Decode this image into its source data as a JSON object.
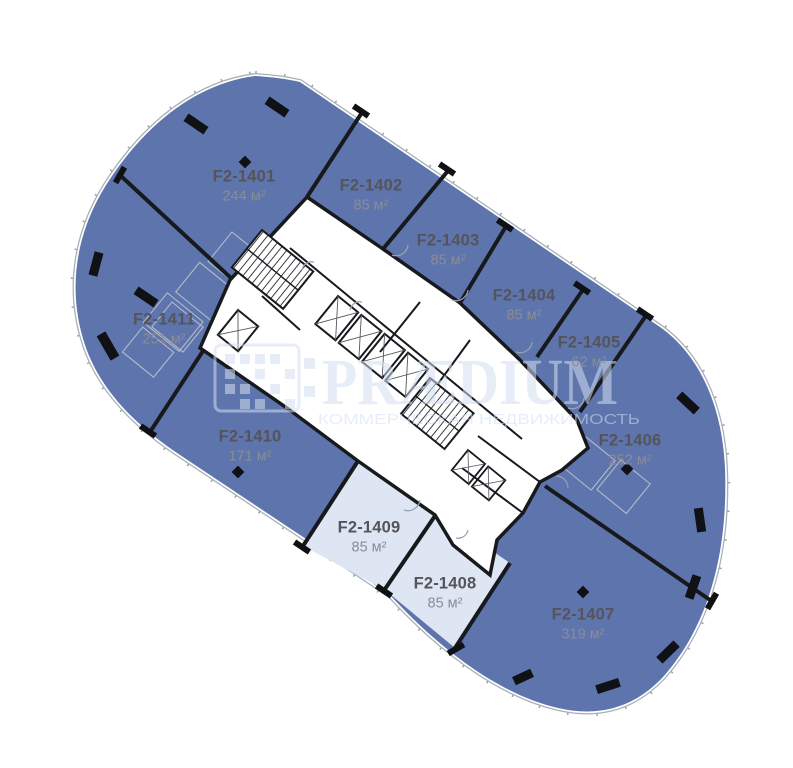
{
  "floorplan": {
    "units": [
      {
        "id": "F2-1401",
        "area": "244 м²",
        "x": 244,
        "y": 186,
        "highlighted": false
      },
      {
        "id": "F2-1402",
        "area": "85 м²",
        "x": 371,
        "y": 195,
        "highlighted": false
      },
      {
        "id": "F2-1403",
        "area": "85 м²",
        "x": 448,
        "y": 250,
        "highlighted": false
      },
      {
        "id": "F2-1404",
        "area": "85 м²",
        "x": 524,
        "y": 305,
        "highlighted": false
      },
      {
        "id": "F2-1405",
        "area": "62 м²",
        "x": 589,
        "y": 352,
        "highlighted": false
      },
      {
        "id": "F2-1406",
        "area": "252 м²",
        "x": 630,
        "y": 450,
        "highlighted": false
      },
      {
        "id": "F2-1407",
        "area": "319 м²",
        "x": 583,
        "y": 624,
        "highlighted": false
      },
      {
        "id": "F2-1408",
        "area": "85 м²",
        "x": 445,
        "y": 593,
        "highlighted": true
      },
      {
        "id": "F2-1409",
        "area": "85 м²",
        "x": 369,
        "y": 537,
        "highlighted": true
      },
      {
        "id": "F2-1410",
        "area": "171 м²",
        "x": 250,
        "y": 446,
        "highlighted": false
      },
      {
        "id": "F2-1411",
        "area": "251 м²",
        "x": 164,
        "y": 329,
        "highlighted": false
      }
    ],
    "watermark": {
      "title": "PRÆDIUM",
      "subtitle": "КОММЕРЧЕСКАЯ НЕДВИЖИМОСТЬ"
    },
    "colors": {
      "unit_fill": "#5d74ad",
      "unit_highlight_fill": "#dde6f2",
      "wall": "#17191d",
      "facade_line": "#a9b0b8",
      "unit_id_text": "#55545b",
      "unit_area_text": "#8d8c92",
      "watermark": "#d3dff0",
      "partition_line": "#b4bbc7"
    }
  }
}
